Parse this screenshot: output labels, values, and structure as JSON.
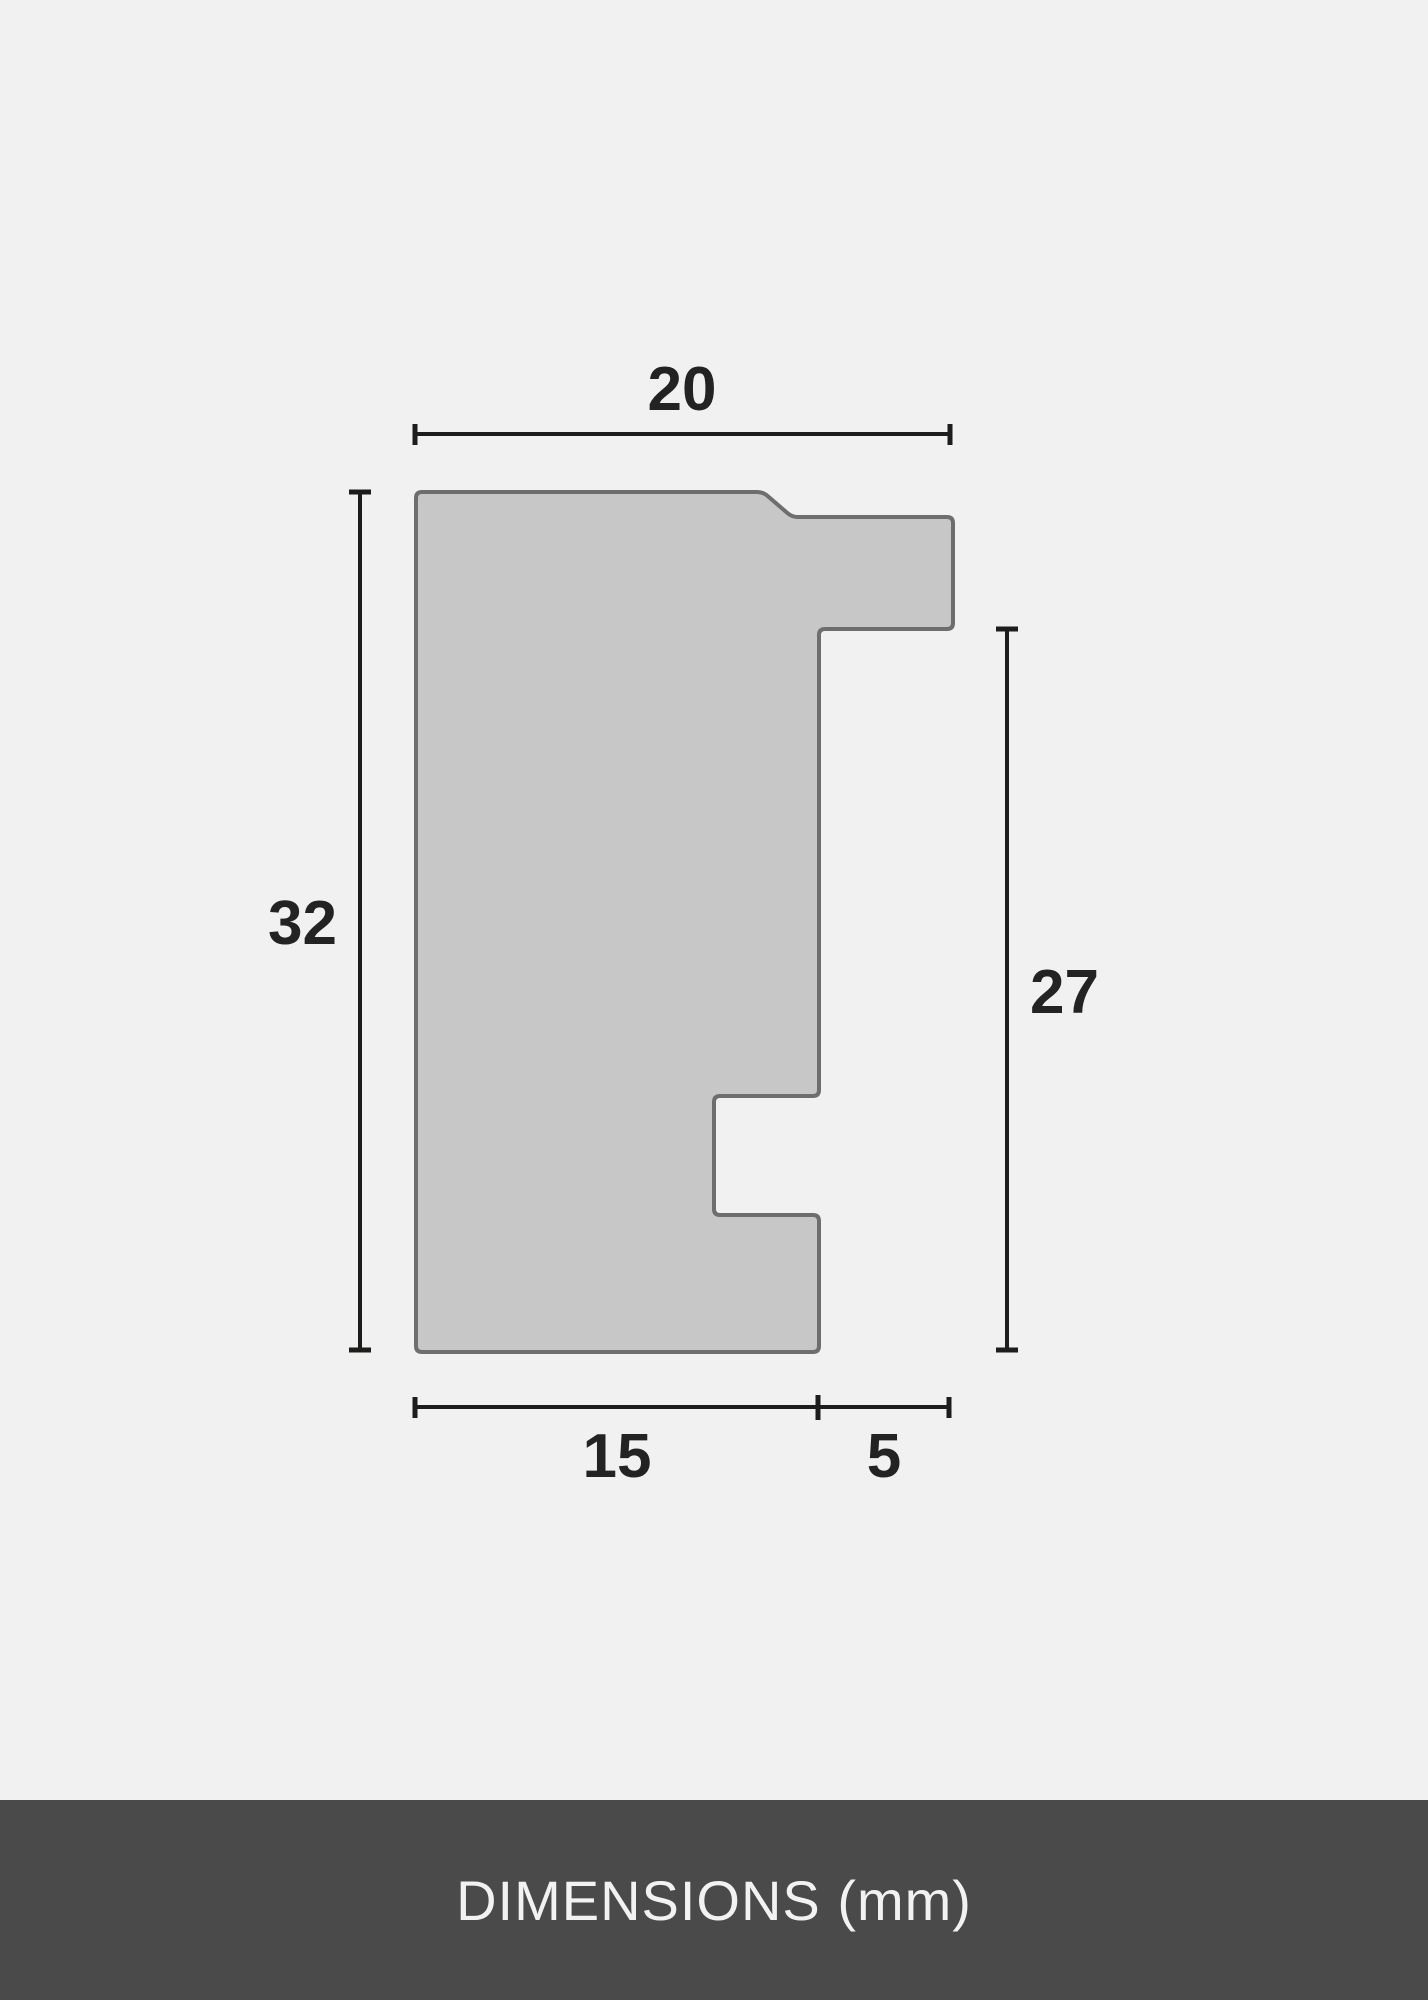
{
  "diagram": {
    "type": "moulding-profile-cross-section",
    "unit": "mm",
    "dimensions": {
      "top_width": "20",
      "left_height": "32",
      "right_height": "27",
      "bottom_inner_width": "15",
      "bottom_outer_width": "5"
    },
    "colors": {
      "background": "#f1f1f1",
      "shape_fill": "#c7c7c7",
      "shape_stroke": "#6e6e6e",
      "dimension_line": "#1d1d1b",
      "label_text": "#232323",
      "footer_background": "#4a4a4a",
      "footer_text": "#f2f2f2"
    }
  },
  "footer": {
    "title": "DIMENSIONS (mm)"
  }
}
